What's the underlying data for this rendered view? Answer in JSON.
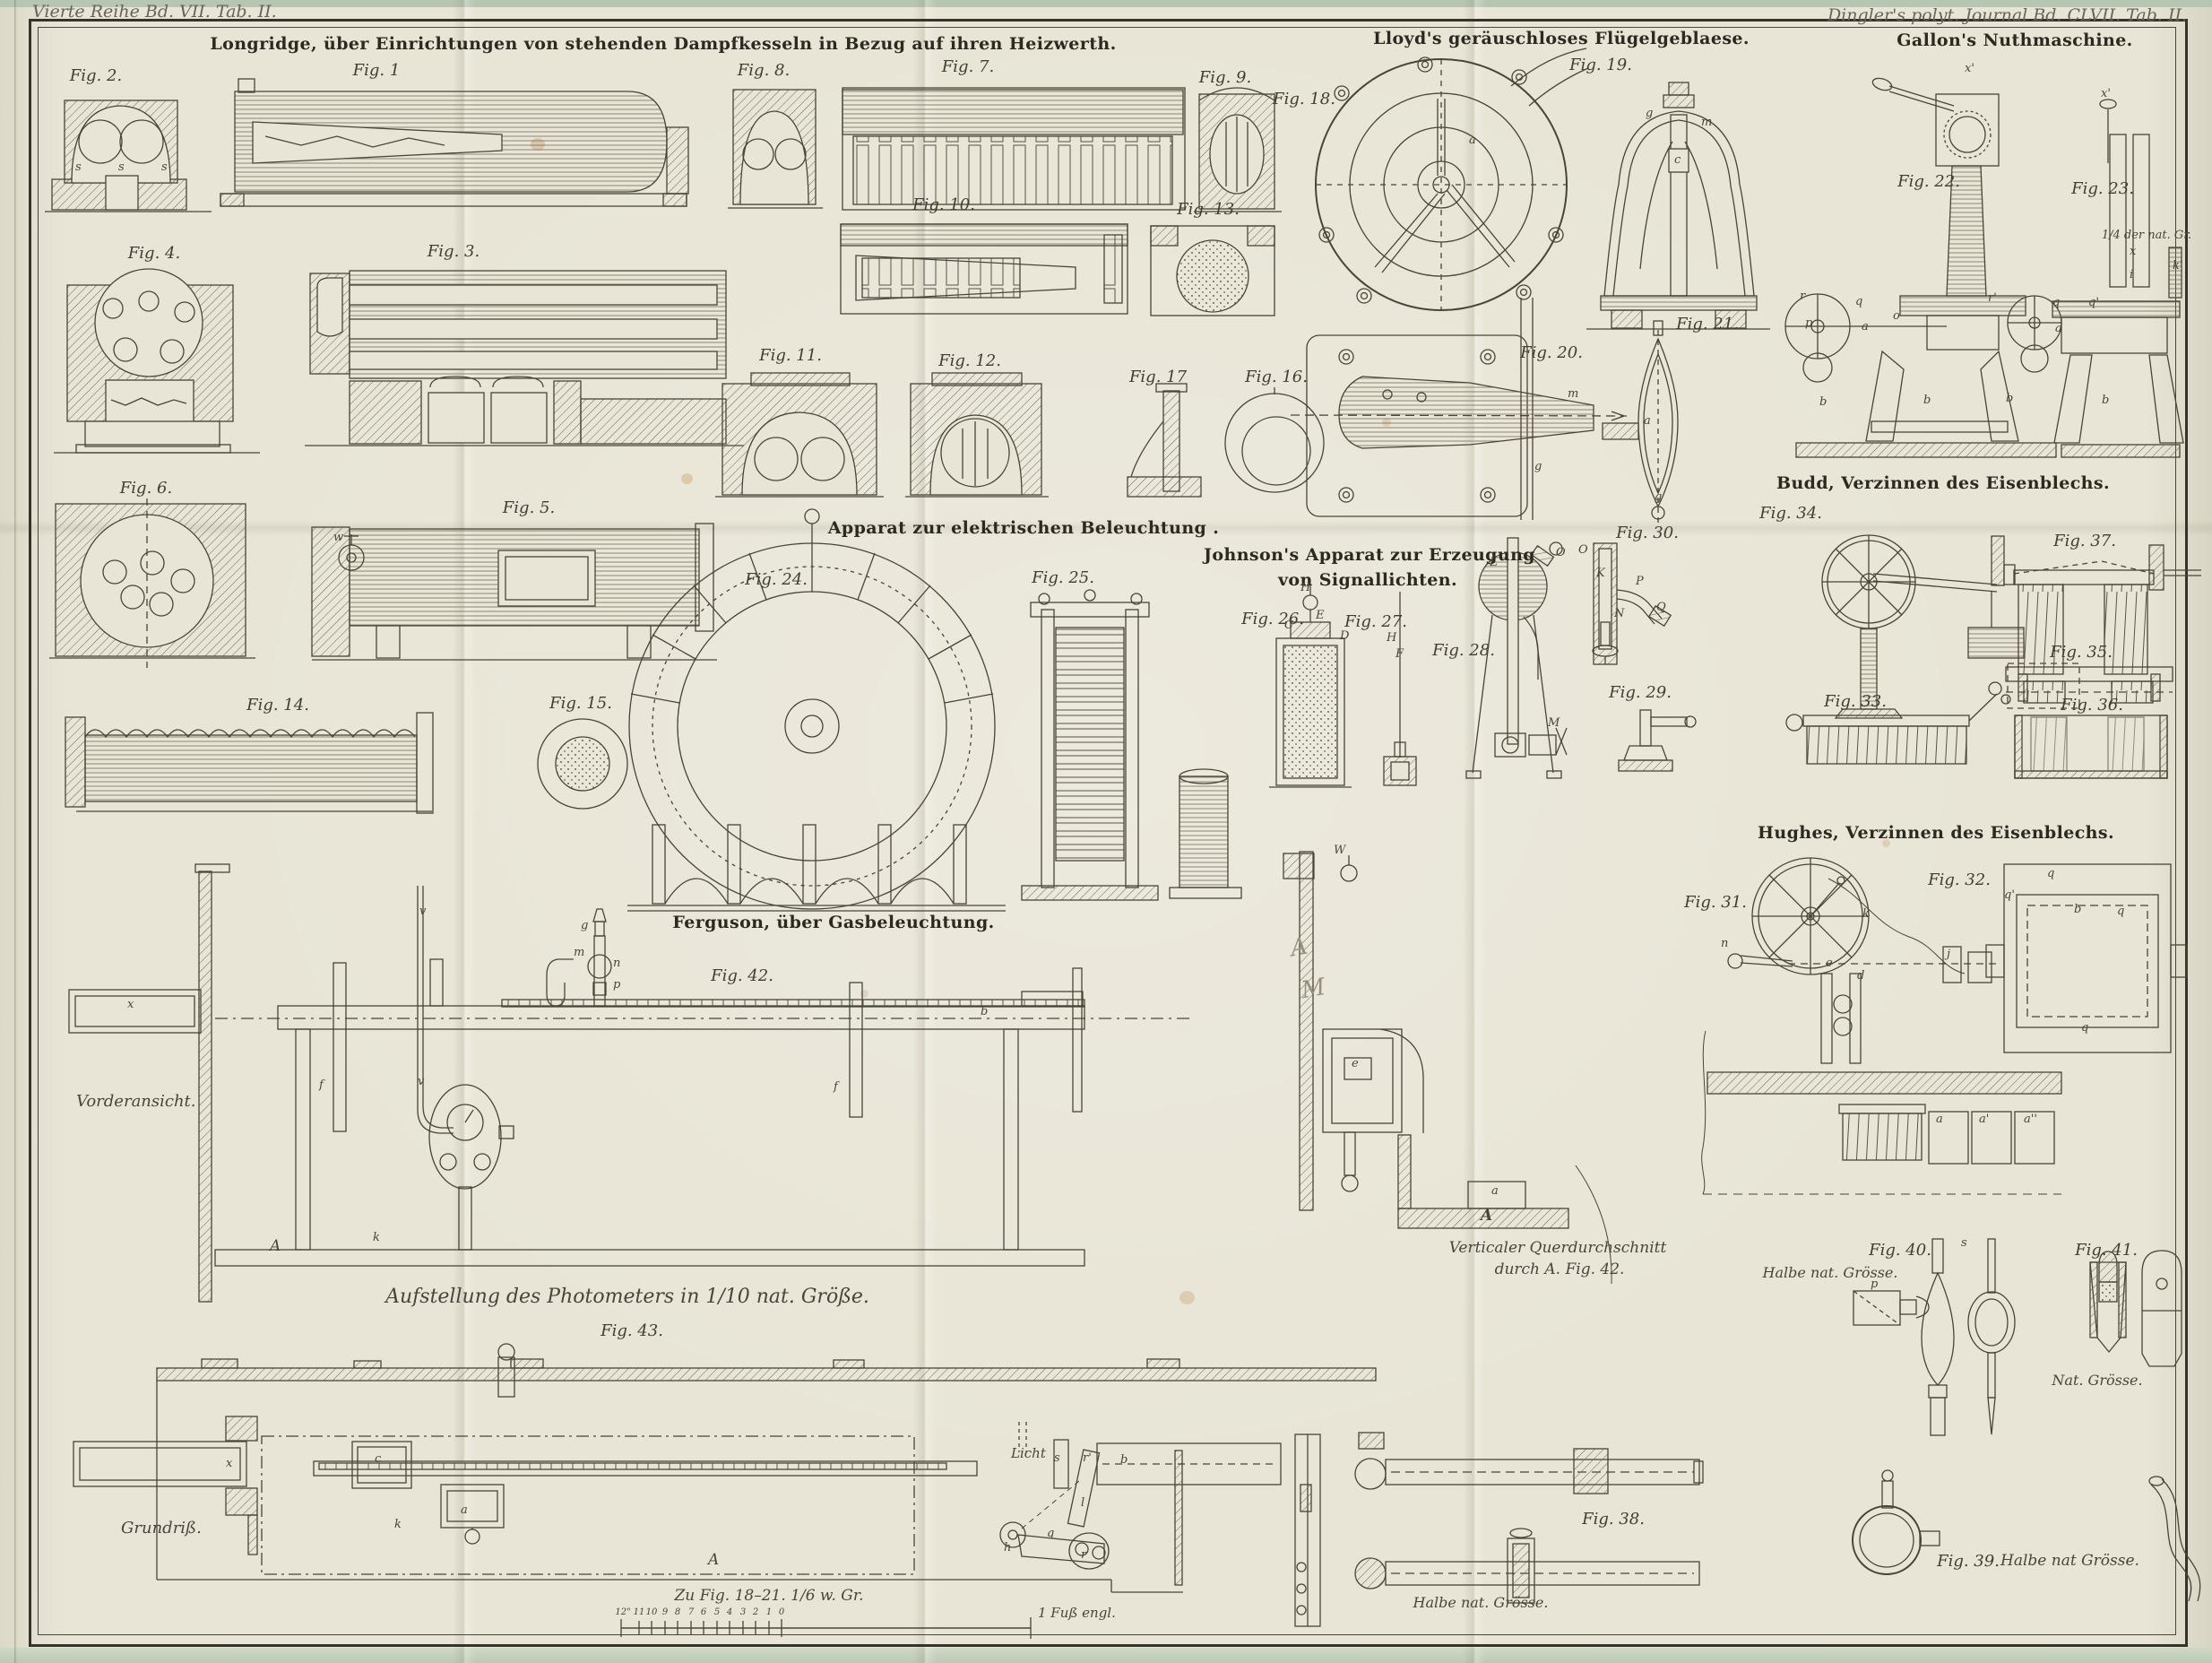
{
  "margins": {
    "series_note": "Vierte Reihe Bd. VII. Tab. II.",
    "journal_note": "Dingler's polyt. Journal Bd. CLVII. Tab. II."
  },
  "sections": {
    "longridge": "Longridge, über Einrichtungen von stehenden Dampfkesseln in Bezug auf ihren Heizwerth.",
    "lloyd": "Lloyd's geräuschloses Flügelgeblaese.",
    "gallon": "Gallon's Nuthmaschine.",
    "elektrisch": "Apparat zur elektrischen Beleuchtung .",
    "johnson1": "Johnson's Apparat zur Erzeugung",
    "johnson2": "von Signallichten.",
    "budd": "Budd, Verzinnen des Eisenblechs.",
    "hughes": "Hughes, Verzinnen des Eisenblechs.",
    "ferguson": "Ferguson, über Gasbeleuchtung.",
    "photometer": "Aufstellung des Photometers in 1/10 nat. Größe."
  },
  "figures": {
    "f1": "Fig. 1",
    "f2": "Fig. 2.",
    "f3": "Fig. 3.",
    "f4": "Fig. 4.",
    "f5": "Fig. 5.",
    "f6": "Fig. 6.",
    "f7": "Fig. 7.",
    "f8": "Fig. 8.",
    "f9": "Fig. 9.",
    "f10": "Fig. 10.",
    "f11": "Fig. 11.",
    "f12": "Fig. 12.",
    "f13": "Fig. 13.",
    "f14": "Fig. 14.",
    "f15": "Fig. 15.",
    "f16": "Fig. 16.",
    "f17": "Fig. 17",
    "f18": "Fig. 18.",
    "f19": "Fig. 19.",
    "f20": "Fig. 20.",
    "f21": "Fig. 21.",
    "f22": "Fig. 22.",
    "f23": "Fig. 23.",
    "f24": "Fig. 24.",
    "f25": "Fig. 25.",
    "f26": "Fig. 26.",
    "f27": "Fig. 27.",
    "f28": "Fig. 28.",
    "f29": "Fig. 29.",
    "f30": "Fig. 30.",
    "f31": "Fig. 31.",
    "f32": "Fig. 32.",
    "f33": "Fig. 33.",
    "f34": "Fig. 34.",
    "f35": "Fig. 35.",
    "f36": "Fig. 36.",
    "f37": "Fig. 37.",
    "f38": "Fig. 38.",
    "f39": "Fig. 39.",
    "f40": "Fig. 40.",
    "f41": "Fig. 41.",
    "f42": "Fig. 42.",
    "f43": "Fig. 43."
  },
  "ann": {
    "vorderansicht": "Vorderansicht.",
    "grundriss": "Grundriß.",
    "querschnitt1": "Verticaler Querdurchschnitt",
    "querschnitt2": "durch A. Fig. 42.",
    "halbe40": "Halbe nat. Grösse.",
    "nat41": "Nat. Grösse.",
    "halbe38": "Halbe nat. Grösse.",
    "halbe39": "Halbe nat Grösse.",
    "quarter23": "1/4 der nat. Gr.",
    "licht": "Licht",
    "scale_caption": "Zu Fig. 18–21.  1/6 w. Gr.",
    "fuss": "1 Fuß engl.",
    "scale_ticks": [
      "12\"",
      "11",
      "10",
      "9",
      "8",
      "7",
      "6",
      "5",
      "4",
      "3",
      "2",
      "1",
      "0"
    ]
  },
  "parts": {
    "fig2": [
      "s",
      "s",
      "s"
    ],
    "fig18": [
      "a"
    ],
    "fig19": [
      "g",
      "m",
      "c"
    ],
    "fig20": [
      "m",
      "g"
    ],
    "fig21": [
      "a",
      "g"
    ],
    "fig22": [
      "x'",
      "r",
      "p",
      "q",
      "o",
      "a",
      "b",
      "b"
    ],
    "fig23": [
      "x'",
      "x",
      "i",
      "k'",
      "r'",
      "q",
      "q'",
      "a",
      "b",
      "b"
    ],
    "fig26": [
      "H",
      "C",
      "E",
      "D"
    ],
    "fig27": [
      "H",
      "F"
    ],
    "fig28": [
      "L",
      "O",
      "M"
    ],
    "fig30": [
      "O",
      "K",
      "P",
      "N",
      "Q"
    ],
    "fig31": [
      "k",
      "n",
      "e",
      "d",
      "j",
      "a",
      "a'",
      "a''"
    ],
    "fig32": [
      "q",
      "q'",
      "b",
      "q",
      "q"
    ],
    "fig40": [
      "s",
      "p"
    ],
    "fig42": [
      "w",
      "x",
      "v",
      "v",
      "g",
      "m",
      "n",
      "p",
      "f",
      "f",
      "b",
      "k",
      "A"
    ],
    "fig43": [
      "x",
      "c",
      "k",
      "a",
      "A",
      "s",
      "r'",
      "b",
      "l",
      "h",
      "q",
      "r"
    ],
    "section": [
      "W",
      "e",
      "a",
      "A"
    ],
    "pencil": [
      "A",
      "M"
    ]
  }
}
